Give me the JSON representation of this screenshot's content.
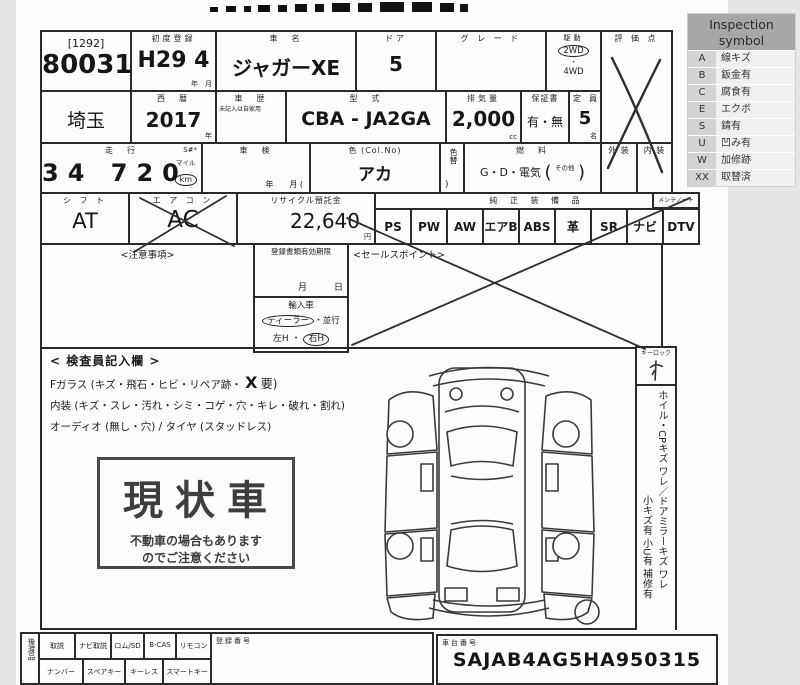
{
  "legend": {
    "title": "Inspection symbol",
    "rows": [
      {
        "symbol": "A",
        "label": "線キズ"
      },
      {
        "symbol": "B",
        "label": "鈑金有"
      },
      {
        "symbol": "C",
        "label": "腐食有"
      },
      {
        "symbol": "E",
        "label": "エクボ"
      },
      {
        "symbol": "S",
        "label": "錆有"
      },
      {
        "symbol": "U",
        "label": "凹み有"
      },
      {
        "symbol": "W",
        "label": "加修跡"
      },
      {
        "symbol": "XX",
        "label": "取替済"
      }
    ]
  },
  "sheet": {
    "auction": {
      "bracket_no": "[1292]",
      "lot_no": "80031"
    },
    "first_reg": {
      "label": "初度登録",
      "value": "H29 4",
      "unit": "年　月"
    },
    "car_name": {
      "label": "車　名",
      "value": "ジャガーXE"
    },
    "door": {
      "label": "ドア",
      "value": "5"
    },
    "grade": {
      "label": "グ レ ー ド",
      "value": ""
    },
    "drive": {
      "label": "駆動",
      "opt1": "2WD",
      "opt2": "4WD"
    },
    "score": {
      "label": "評 価 点"
    },
    "prefecture": {
      "value": "埼玉"
    },
    "year_west": {
      "label": "西　暦",
      "value": "2017",
      "unit": "年"
    },
    "history": {
      "label": "車　歴",
      "note": "未記入は自家用"
    },
    "model_code": {
      "label": "型　式",
      "value": "CBA - JA2GA"
    },
    "displacement": {
      "label": "排気量",
      "value": "2,000",
      "unit": "cc"
    },
    "warranty": {
      "label": "保証書",
      "value": "有・無"
    },
    "capacity": {
      "label": "定　員",
      "value": "5",
      "unit": "名"
    },
    "mileage": {
      "label": "走　行",
      "s_mark": "S#*",
      "value": "34 720",
      "unit_mile": "マイル",
      "unit_km": "km"
    },
    "shaken": {
      "label": "車　検",
      "unit": "年　　月 ("
    },
    "color": {
      "label": "色 (Col.No)",
      "value": "アカ"
    },
    "color_change": {
      "label": "色替",
      "paren": ")"
    },
    "fuel": {
      "label": "燃　料",
      "value": "G・D・電気",
      "open": "(",
      "other": "その他",
      "close": ")"
    },
    "exterior": {
      "label": "外 装"
    },
    "interior": {
      "label": "内 装"
    },
    "shift": {
      "label": "シ フ ト",
      "value": "AT"
    },
    "aircon": {
      "label": "エ ア コ ン",
      "value": "AC"
    },
    "recycle": {
      "label": "リサイクル預託金",
      "value": "22,640",
      "unit": "円"
    },
    "equipment": {
      "label": "純 正 装 備 品",
      "note": "メンテノート",
      "items": [
        "PS",
        "PW",
        "AW",
        "エアB",
        "ABS",
        "革",
        "SR",
        "ナビ",
        "DTV"
      ]
    },
    "notes_box": {
      "label": "<注意事項>"
    },
    "docs_deadline": {
      "label": "登録書類有効期限",
      "unit": "月　　　日"
    },
    "import_box": {
      "label": "輸入車",
      "dealer": "ディーラー",
      "parallel": "・並行",
      "left_h": "左H",
      "dot": "・",
      "right_h": "右H"
    },
    "sales_point": {
      "label": "<セールスポイント>"
    },
    "inspector": {
      "title": "< 検査員記入欄 >",
      "line1_prefix": "Fガラス (キズ・飛石・ヒビ・リペア跡・",
      "line1_mark": "X",
      "line1_suffix": "要)",
      "line2": "内装 (キズ・スレ・汚れ・シミ・コゲ・穴・キレ・破れ・割れ)",
      "line3": "オーディオ (無し・穴) / タイヤ (スタッドレス)"
    },
    "stamp": {
      "big": "現状車",
      "sub1": "不動車の場合もあります",
      "sub2": "のでご注意ください"
    },
    "keylock": {
      "label": "キーロック"
    },
    "side_note_1": "ホイル・CPキズ ワレ／ドアミラーキズ ワレ",
    "side_note_2": "小キズ有 小U有 補修有",
    "handover": {
      "label": "後渡品",
      "row1": [
        "取説",
        "ナビ取説",
        "ロム/SD",
        "B-CAS",
        "リモコン"
      ],
      "row2": [
        "ナンバー",
        "スペアキー",
        "キーレス",
        "スマートキー"
      ],
      "reg_no_label": "登録番号"
    },
    "vin": {
      "label": "車台番号",
      "value": "SAJAB4AG5HA950315"
    }
  }
}
